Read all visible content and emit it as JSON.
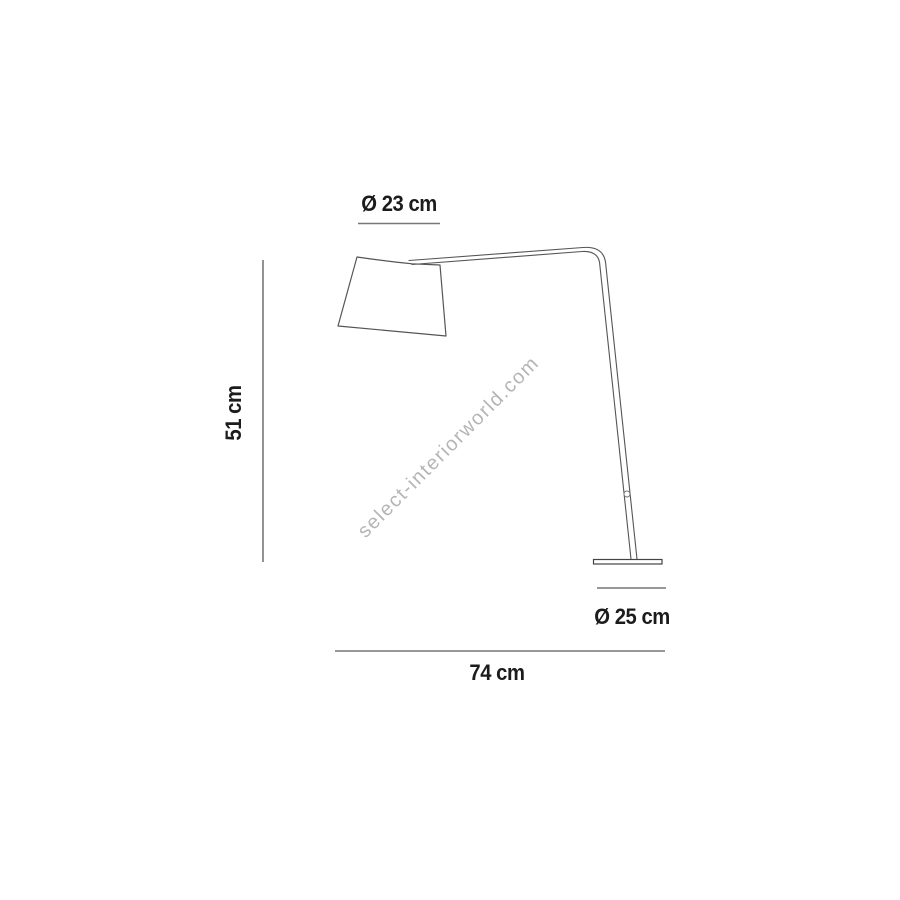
{
  "diagram": {
    "type": "product-dimension-drawing",
    "subject": "arc floor lamp with conical shade and flat round base",
    "watermark": "select-interiorworld.com",
    "dimensions": {
      "shade_diameter": "Ø 23 cm",
      "height": "51 cm",
      "base_diameter": "Ø 25 cm",
      "width": "74 cm"
    },
    "colors": {
      "background": "#ffffff",
      "outline": "#555555",
      "dimension_line": "#777777",
      "label_text": "#1c1c1c",
      "watermark_text": "#b5b5b5"
    }
  }
}
